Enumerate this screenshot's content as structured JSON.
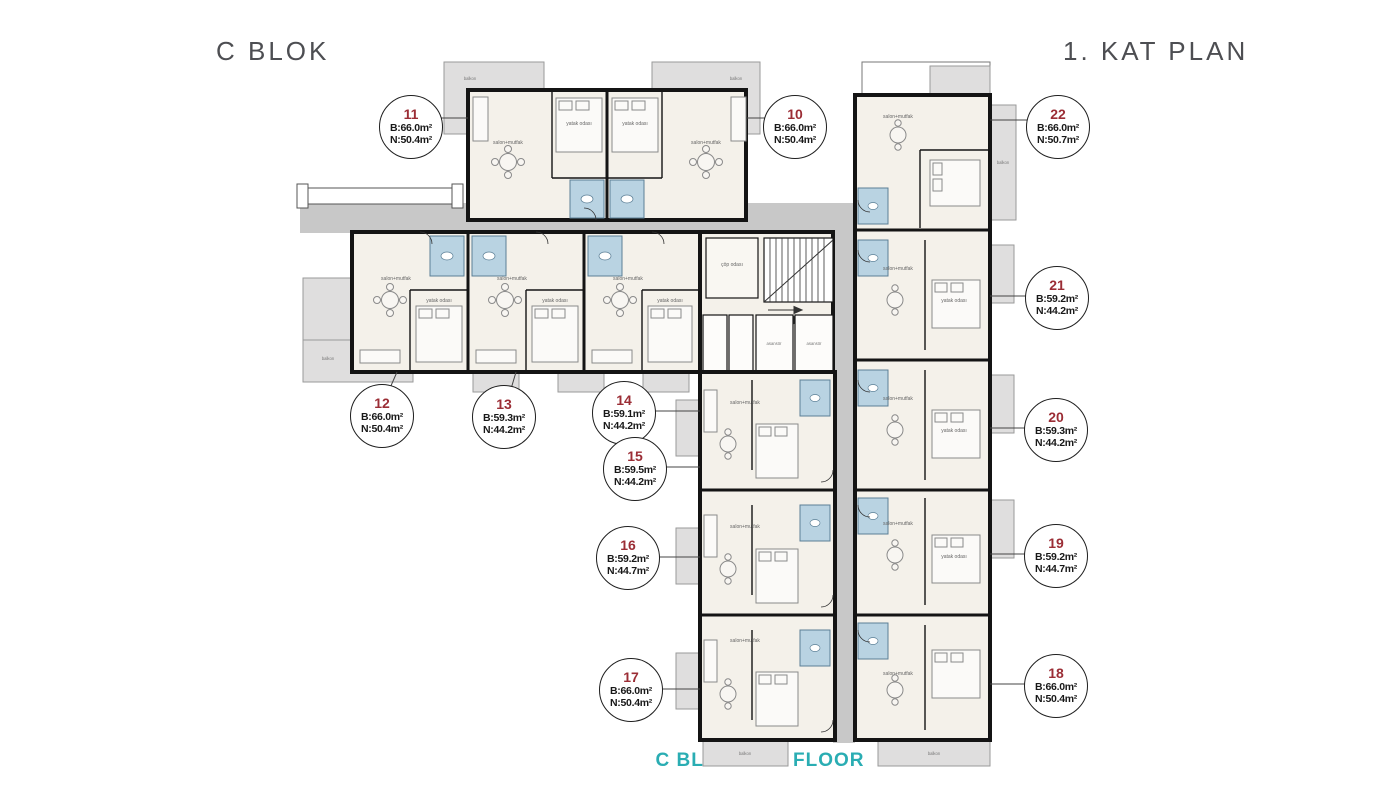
{
  "header": {
    "left_title": "C BLOK",
    "right_title": "1. KAT PLAN"
  },
  "footer": {
    "caption": "C BLOCK - 1. FLOOR"
  },
  "colors": {
    "accent_teal": "#2aadb3",
    "unit_number_maroon": "#9b2d35",
    "title_gray": "#4d4e52",
    "balcony_gray": "#dfdede",
    "corridor_gray": "#c8c8c8",
    "room_cream": "#f4f1ea",
    "bathroom_blue": "#b9d3e2",
    "wall_black": "#141414"
  },
  "rooms": {
    "salon": "salon+mutfak",
    "bedroom": "yatak odası",
    "balcony": "balkon",
    "trash": "çöp odası",
    "elevator": "asansör"
  },
  "units": [
    {
      "number": "11",
      "b": "B:66.0m²",
      "n": "N:50.4m²"
    },
    {
      "number": "10",
      "b": "B:66.0m²",
      "n": "N:50.4m²"
    },
    {
      "number": "22",
      "b": "B:66.0m²",
      "n": "N:50.7m²"
    },
    {
      "number": "21",
      "b": "B:59.2m²",
      "n": "N:44.2m²"
    },
    {
      "number": "20",
      "b": "B:59.3m²",
      "n": "N:44.2m²"
    },
    {
      "number": "19",
      "b": "B:59.2m²",
      "n": "N:44.7m²"
    },
    {
      "number": "18",
      "b": "B:66.0m²",
      "n": "N:50.4m²"
    },
    {
      "number": "12",
      "b": "B:66.0m²",
      "n": "N:50.4m²"
    },
    {
      "number": "13",
      "b": "B:59.3m²",
      "n": "N:44.2m²"
    },
    {
      "number": "14",
      "b": "B:59.1m²",
      "n": "N:44.2m²"
    },
    {
      "number": "15",
      "b": "B:59.5m²",
      "n": "N:44.2m²"
    },
    {
      "number": "16",
      "b": "B:59.2m²",
      "n": "N:44.7m²"
    },
    {
      "number": "17",
      "b": "B:66.0m²",
      "n": "N:50.4m²"
    }
  ]
}
